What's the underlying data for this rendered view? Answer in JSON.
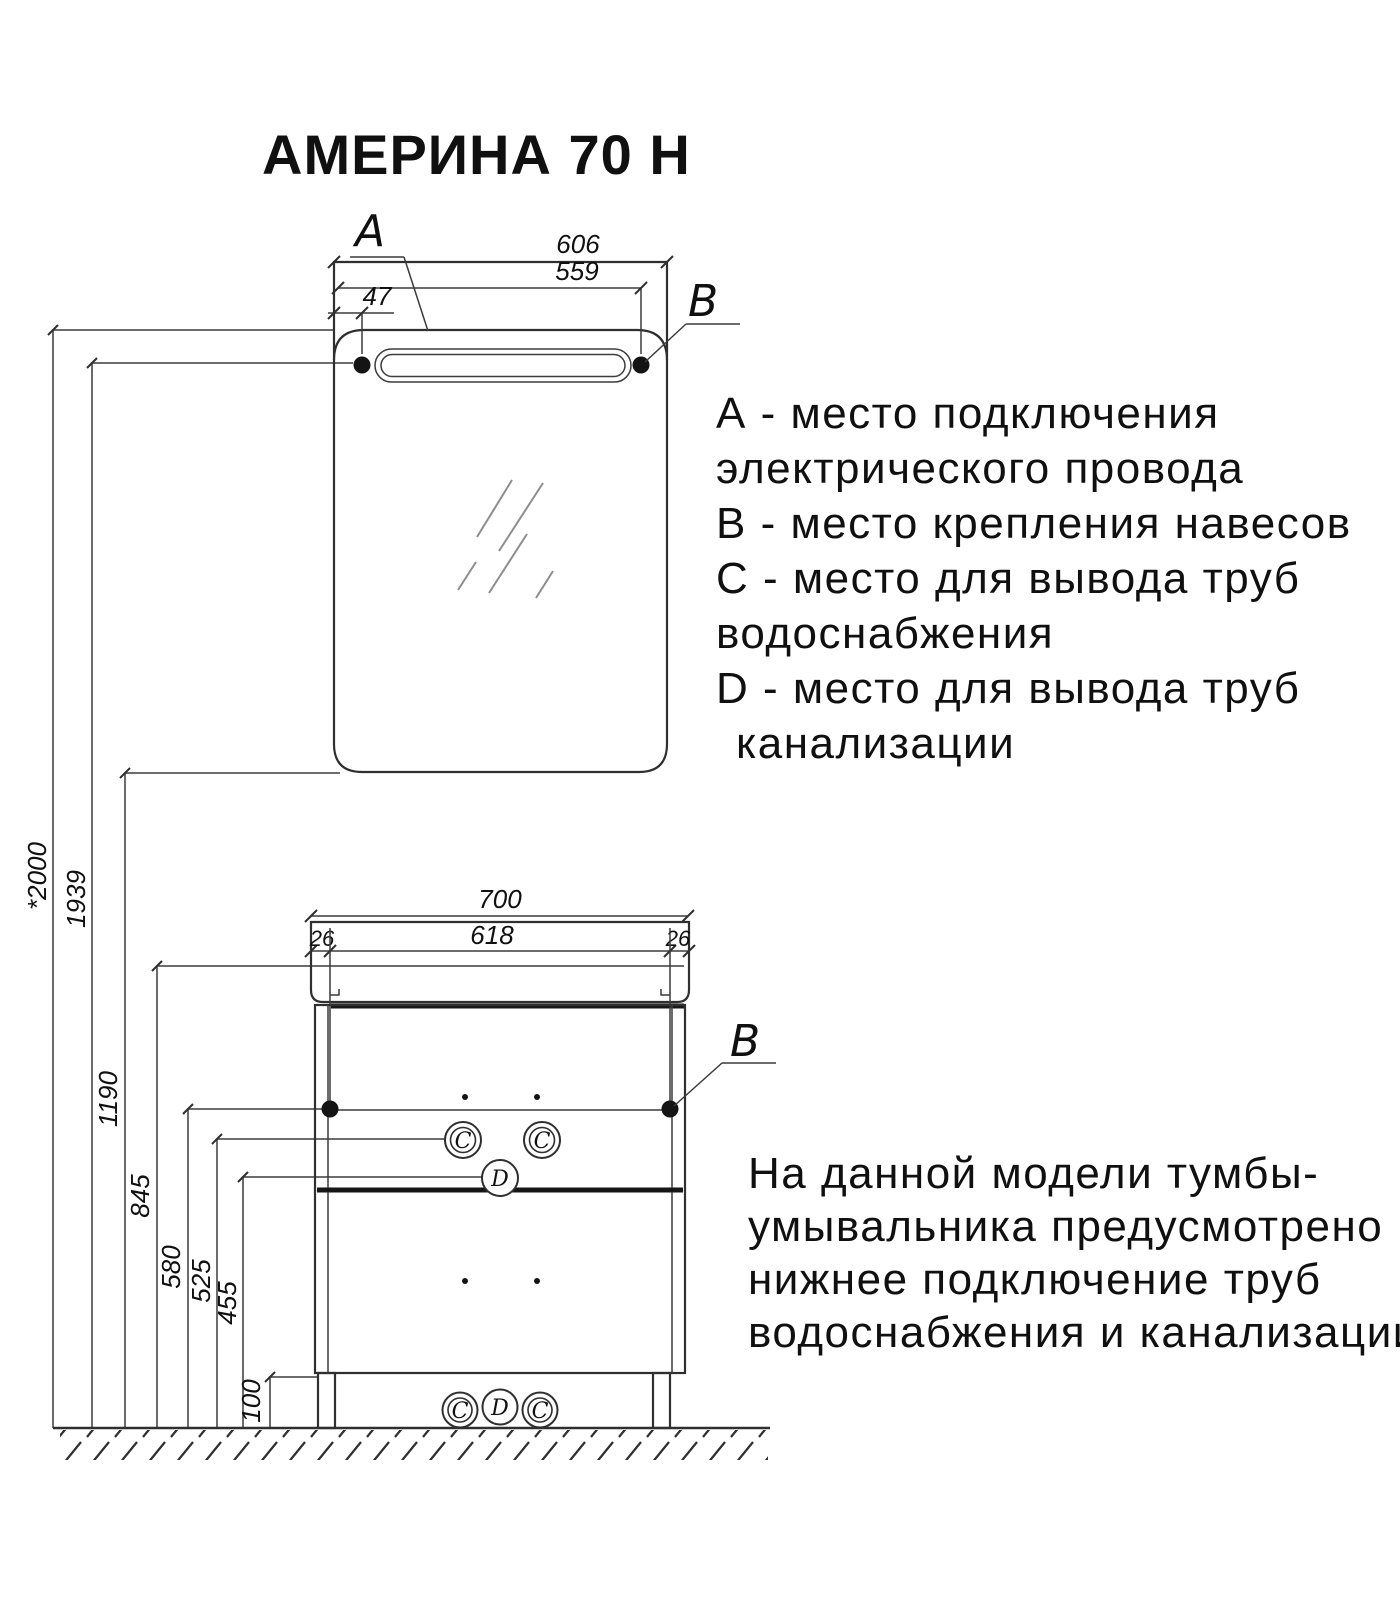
{
  "title": "АМЕРИНА 70 Н",
  "mirror": {
    "label_a": "A",
    "label_b": "B",
    "width_dim": "606",
    "hanger_offset_dim": "559",
    "power_offset_dim": "47"
  },
  "cabinet": {
    "label_b": "B",
    "width_dim": "700",
    "mount_span_dim": "618",
    "side_offset_left_dim": "26",
    "side_offset_right_dim": "26"
  },
  "heights": {
    "mirror_top": "*2000",
    "light": "1939",
    "mirror_bottom": "1190",
    "countertop": "845",
    "hangers": "580",
    "water_supply": "525",
    "drain": "455",
    "plinth": "100"
  },
  "ports": {
    "middle_left": "C",
    "middle_right": "C",
    "middle_drain": "D",
    "bottom": [
      "C",
      "D",
      "C"
    ]
  },
  "legend": {
    "lines": [
      "А - место подключения",
      "электрического провода",
      "В - место крепления навесов",
      "С - место для вывода труб",
      "водоснабжения",
      "D - место для вывода труб",
      "канализации"
    ]
  },
  "note": {
    "lines": [
      "На данной модели тумбы-",
      "умывальника предусмотрено",
      "нижнее подключение труб",
      "водоснабжения и канализации"
    ]
  },
  "colors": {
    "line": "#2f2f2f",
    "text": "#101010",
    "background": "#ffffff"
  }
}
